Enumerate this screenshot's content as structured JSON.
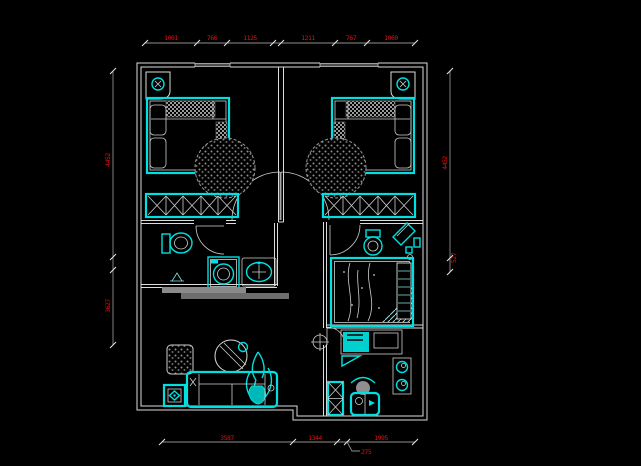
{
  "drawing": {
    "type": "CAD floor plan (two-bedroom apartment furniture layout)",
    "background": "#000000"
  },
  "colors": {
    "walls": "#dcdcdc",
    "furniture": "#00e0e0",
    "dimension_text": "#e01010",
    "dimension_line": "#8f8f8f",
    "hatch": "#9a9a9a"
  },
  "dimensions": {
    "top": [
      "1001",
      "766",
      "1125",
      "1211",
      "767",
      "1060"
    ],
    "left": [
      "4452",
      "3627"
    ],
    "right": [
      "4452",
      "527"
    ],
    "bottom": [
      "3587",
      "1344",
      "1995"
    ],
    "bottom_leader": "275"
  }
}
